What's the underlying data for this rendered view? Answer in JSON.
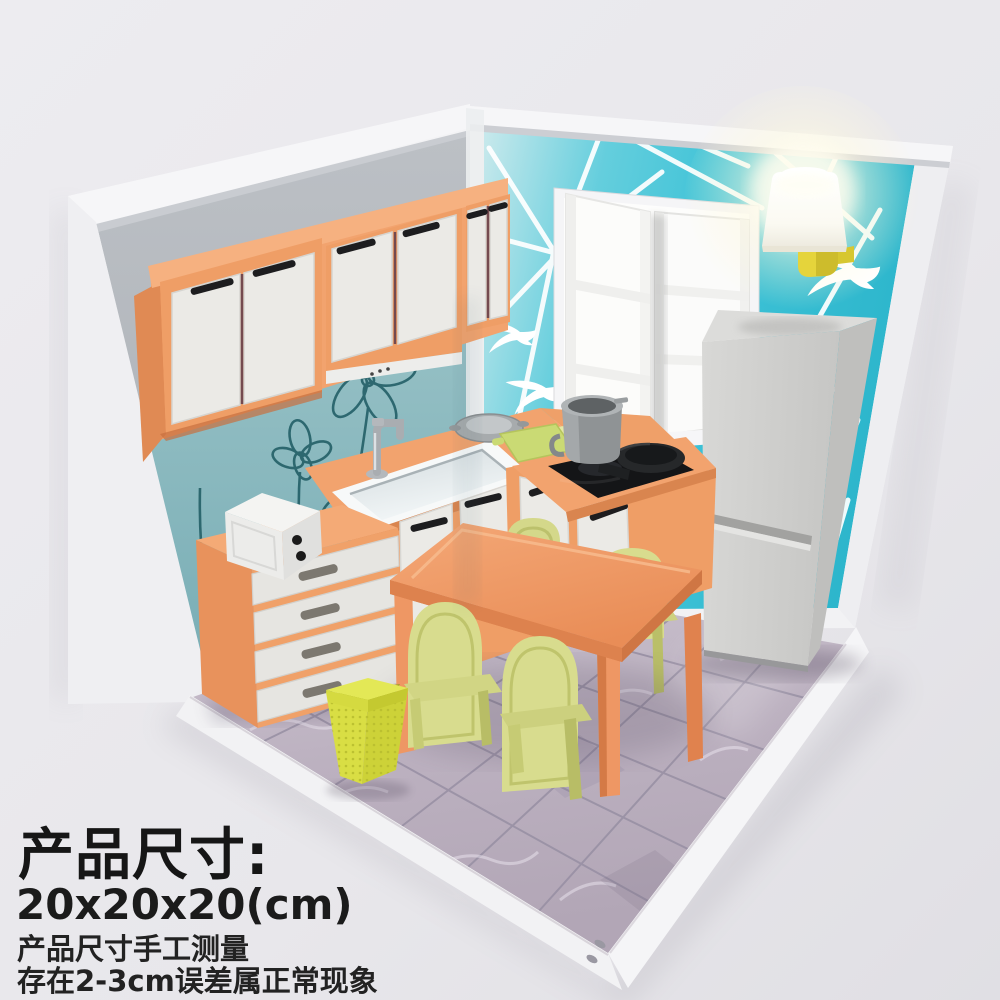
{
  "overlay": {
    "title": "产品尺寸:",
    "dimensions": "20x20x20(cm)",
    "note_line1": "产品尺寸手工测量",
    "note_line2": "存在2-3cm误差属正常现象"
  },
  "colors": {
    "background": "#eae9ed",
    "wall_teal": "#3fc3d7",
    "backsplash_teal": "#86b7bd",
    "frame_white": "#f4f4f6",
    "cabinet_orange": "#f2a36e",
    "door_white": "#ebeae6",
    "handle_black": "#1d1d1f",
    "fridge_gray": "#cdcdcb",
    "chair_green": "#d8dc8e",
    "table_orange": "#f0a06c",
    "trash_yellow": "#d9de44",
    "floor_tile": "#bdb3c1",
    "lamp_yellow": "#e5d43b",
    "text_color": "#161616"
  }
}
